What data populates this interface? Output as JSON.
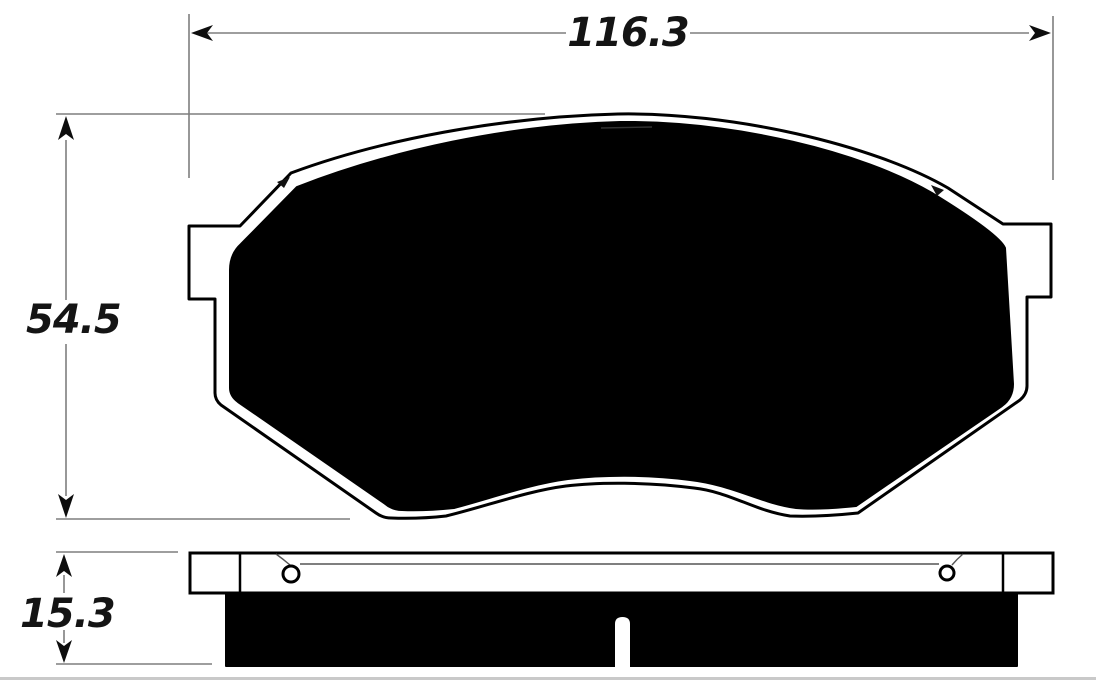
{
  "diagram": {
    "kind": "brake-pad-dimensional-drawing",
    "views": [
      "pad-face-outline",
      "pad-side-profile"
    ]
  },
  "dimensions": {
    "width": "116.3",
    "height": "54.5",
    "thickness": "15.3"
  },
  "colors": {
    "outline": "#000000",
    "fill": "#000000",
    "dimension": "#7e7e7e",
    "text": "#141414",
    "background": "#ffffff",
    "photo_edge": "#c9c9c9"
  }
}
